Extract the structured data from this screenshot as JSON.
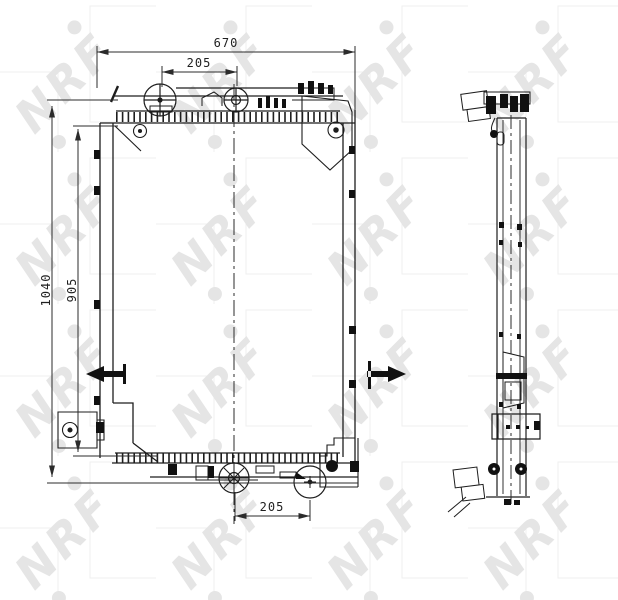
{
  "drawing": {
    "watermark": {
      "text": "NRF",
      "color": "#e5e5e5"
    },
    "colors": {
      "line": "#1d1d1d",
      "dimension": "#2b2b2b",
      "background": "#ffffff"
    },
    "dimensions": {
      "overall_width": "670",
      "top_port_spacing": "205",
      "overall_height": "1040",
      "core_height": "905",
      "bottom_port_spacing": "205"
    }
  }
}
